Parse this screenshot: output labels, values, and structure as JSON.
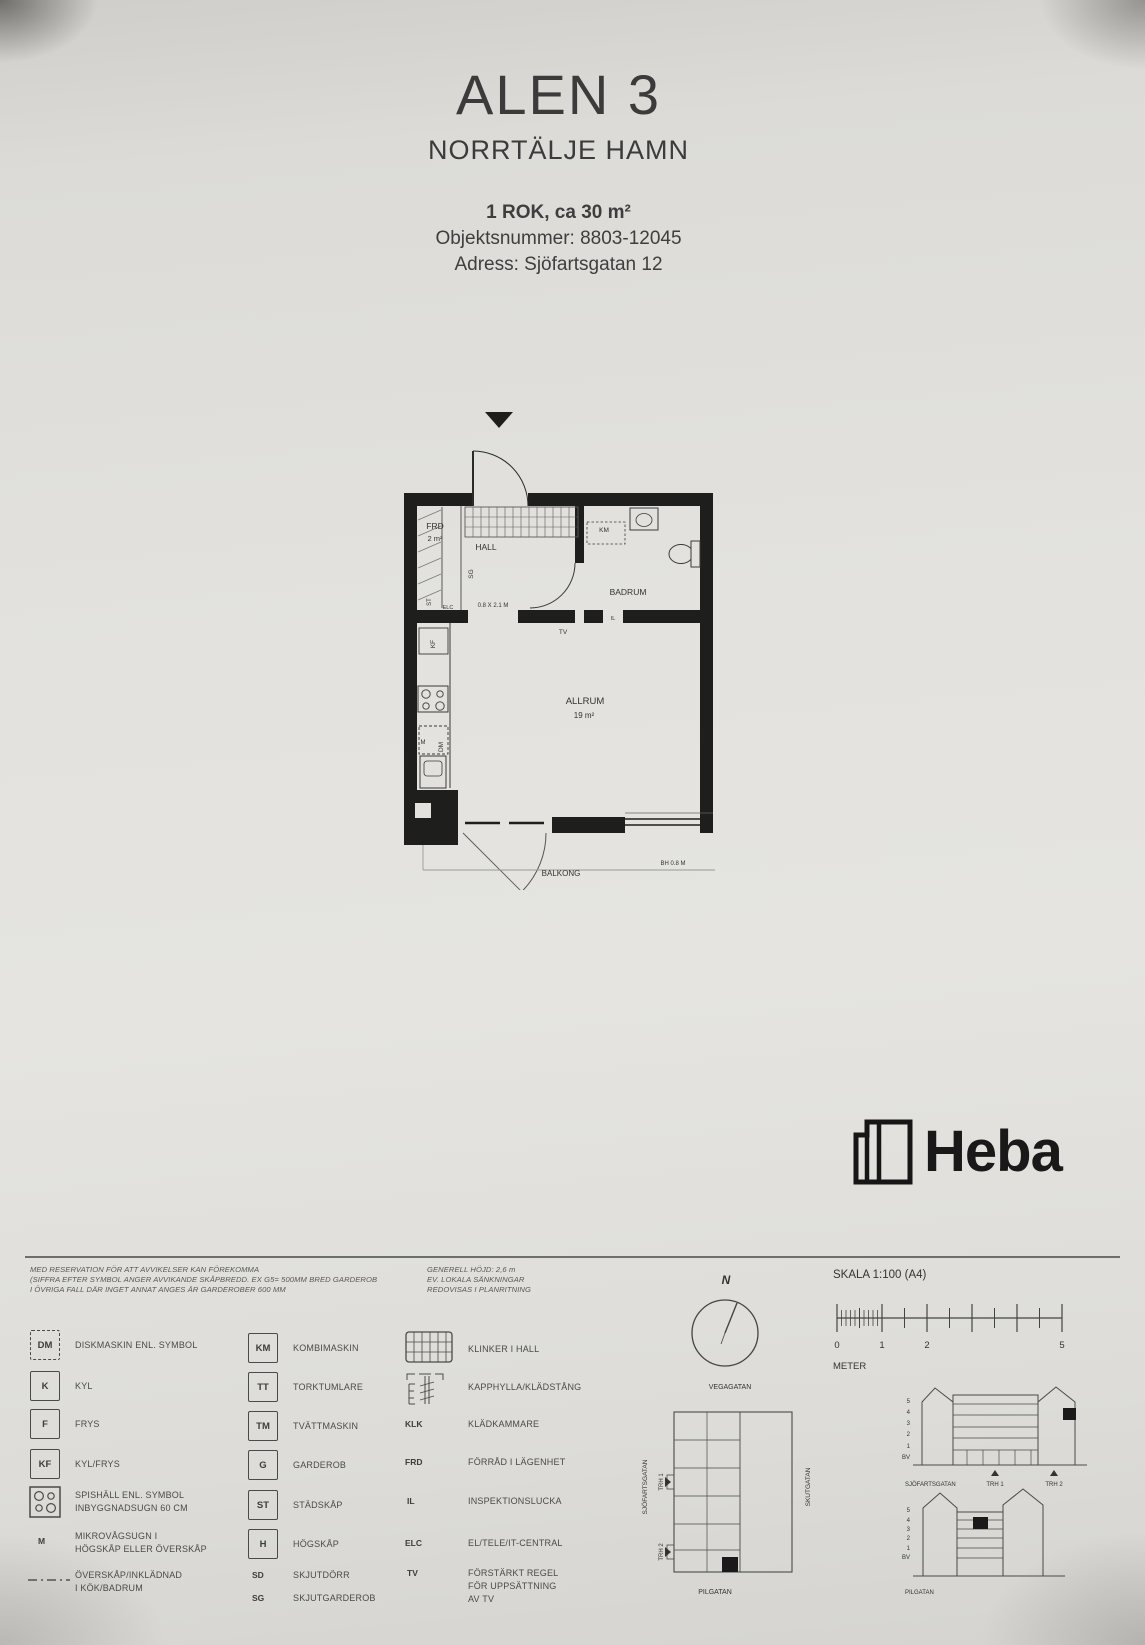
{
  "header": {
    "title": "ALEN 3",
    "subtitle": "NORRTÄLJE HAMN",
    "rok": "1 ROK, ca 30 m²",
    "objekt": "Objektsnummer: 8803-12045",
    "adress": "Adress: Sjöfartsgatan 12"
  },
  "plan": {
    "frd": "FRD",
    "frd_area": "2 m²",
    "hall": "HALL",
    "sg": "SG",
    "st": "ST",
    "elc": "ELC",
    "door_dim": "0.8 X 2.1 M",
    "km": "KM",
    "badrum": "BADRUM",
    "il": "IL",
    "tv": "TV",
    "kf": "KF",
    "m": "M",
    "dm": "DM",
    "allrum": "ALLRUM",
    "allrum_area": "19 m²",
    "bh": "BH 0.8 M",
    "balkong": "BALKONG"
  },
  "brand": {
    "name": "Heba"
  },
  "legend": {
    "disclaimer_left": [
      "MED RESERVATION FÖR ATT AVVIKELSER KAN FÖREKOMMA",
      "(SIFFRA EFTER SYMBOL ANGER AVVIKANDE SKÅPBREDD. EX G5= 500MM BRED GARDEROB",
      "I ÖVRIGA FALL DÄR INGET ANNAT ANGES ÄR GARDEROBER 600 MM"
    ],
    "disclaimer_right": [
      "GENERELL HÖJD:  2,6 m",
      "EV. LOKALA SÄNKNINGAR",
      "REDOVISAS I PLANRITNING"
    ],
    "col1": [
      {
        "sym": "DM",
        "label": "DISKMASKIN ENL. SYMBOL"
      },
      {
        "sym": "K",
        "label": "KYL"
      },
      {
        "sym": "F",
        "label": "FRYS"
      },
      {
        "sym": "KF",
        "label": "KYL/FRYS"
      },
      {
        "label": "SPISHÄLL ENL. SYMBOL",
        "label2": "INBYGGNADSUGN 60 CM"
      },
      {
        "sym": "M",
        "label": "MIKROVÅGSUGN I",
        "label2": "HÖGSKÅP ELLER ÖVERSKÅP"
      },
      {
        "label": "ÖVERSKÅP/INKLÄDNAD",
        "label2": "I KÖK/BADRUM"
      }
    ],
    "col2": [
      {
        "sym": "KM",
        "label": "KOMBIMASKIN"
      },
      {
        "sym": "TT",
        "label": "TORKTUMLARE"
      },
      {
        "sym": "TM",
        "label": "TVÄTTMASKIN"
      },
      {
        "sym": "G",
        "label": "GARDEROB"
      },
      {
        "sym": "ST",
        "label": "STÄDSKÅP"
      },
      {
        "sym": "H",
        "label": "HÖGSKÅP"
      },
      {
        "sym": "SD",
        "label": "SKJUTDÖRR"
      },
      {
        "sym": "SG",
        "label": "SKJUTGARDEROB"
      }
    ],
    "col3": [
      {
        "label": "KLINKER I HALL"
      },
      {
        "label": "KAPPHYLLA/KLÄDSTÅNG"
      },
      {
        "sym": "KLK",
        "label": "KLÄDKAMMARE"
      },
      {
        "sym": "FRD",
        "label": "FÖRRÅD I LÄGENHET"
      },
      {
        "sym": "IL",
        "label": "INSPEKTIONSLUCKA"
      },
      {
        "sym": "ELC",
        "label": "EL/TELE/IT-CENTRAL"
      },
      {
        "sym": "TV",
        "label": "FÖRSTÄRKT REGEL",
        "label2": "FÖR UPPSÄTTNING",
        "label3": "AV TV"
      }
    ]
  },
  "compass": {
    "n": "N"
  },
  "site": {
    "vegagatan": "VEGAGATAN",
    "sjofartsgatan": "SJÖFARTSGATAN",
    "trh1": "TRH 1",
    "trh2": "TRH 2",
    "skutgatan": "SKUTGATAN",
    "pilgatan": "PILGATAN"
  },
  "scalebar": {
    "title": "SKALA 1:100 (A4)",
    "n0": "0",
    "n1": "1",
    "n2": "2",
    "n5": "5",
    "unit": "METER"
  },
  "elev": {
    "floors": [
      "5",
      "4",
      "3",
      "2",
      "1",
      "BV"
    ],
    "street_top": "SJÖFARTSGATAN",
    "trh1": "TRH 1",
    "trh2": "TRH 2",
    "street_bottom": "PILGATAN"
  }
}
